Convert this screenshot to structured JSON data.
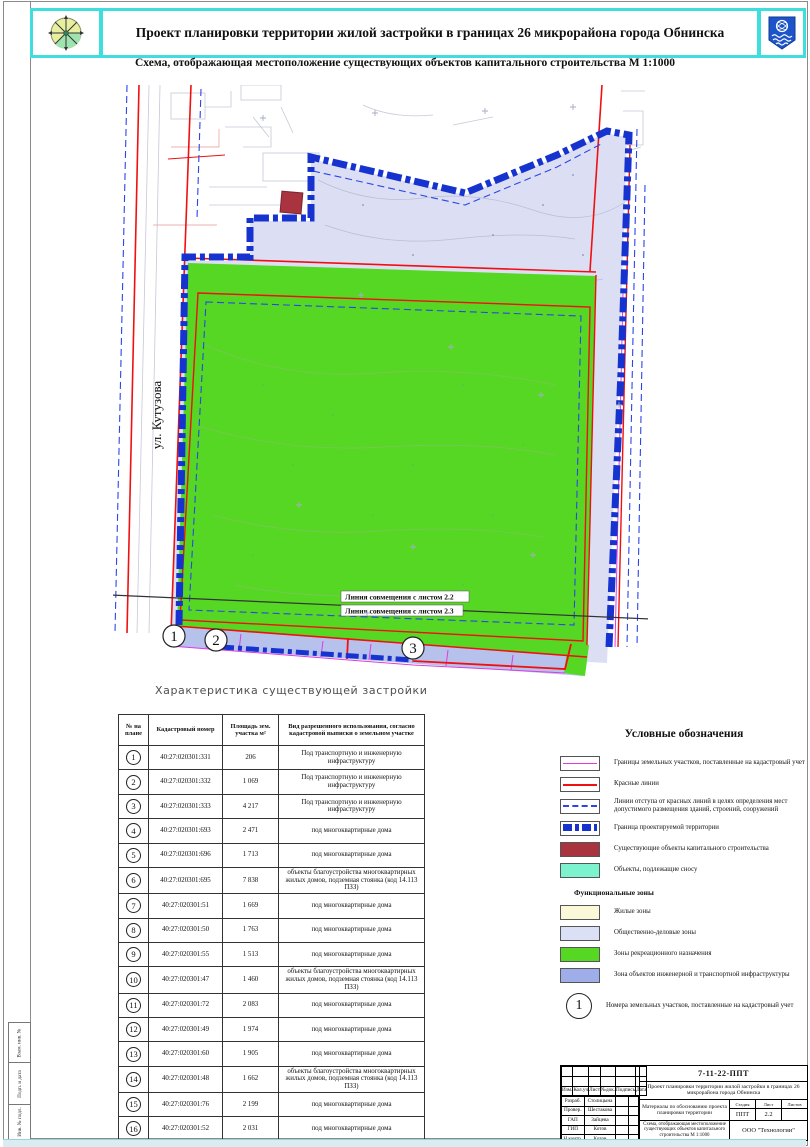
{
  "header": {
    "title": "Проект планировки территории жилой застройки в границах 26 микрорайона города Обнинска"
  },
  "subtitle": "Схема, отображающая местоположение существующих объектов капитального строительства М 1:1000",
  "map": {
    "street_label": "ул. Кутузова",
    "align_line_1": "Линия совмещения с листом 2.2",
    "align_line_2": "Линия совмещения с листом 2.3",
    "markers": [
      "1",
      "2",
      "3"
    ]
  },
  "table": {
    "heading": "Характеристика существующей застройки",
    "columns": [
      "№ на плане",
      "Кадастровый номер",
      "Площадь зем. участка м²",
      "Вид разрешенного использования, согласно кадастровой выписки о земельном участке"
    ],
    "rows": [
      {
        "num": "1",
        "cadastral": "40:27:020301:331",
        "area": "206",
        "use": "Под транспортную и инженерную инфраструктуру"
      },
      {
        "num": "2",
        "cadastral": "40:27:020301:332",
        "area": "1 069",
        "use": "Под транспортную и инженерную инфраструктуру"
      },
      {
        "num": "3",
        "cadastral": "40:27:020301:333",
        "area": "4 217",
        "use": "Под транспортную и инженерную инфраструктуру"
      },
      {
        "num": "4",
        "cadastral": "40:27:020301:693",
        "area": "2 471",
        "use": "под многоквартирные дома"
      },
      {
        "num": "5",
        "cadastral": "40:27:020301:696",
        "area": "1 713",
        "use": "под многоквартирные дома"
      },
      {
        "num": "6",
        "cadastral": "40:27:020301:695",
        "area": "7 838",
        "use": "объекты благоустройства многоквартирных жилых домов, подземная стоянка (код 14.113 ПЗЗ)"
      },
      {
        "num": "7",
        "cadastral": "40:27:020301:51",
        "area": "1 669",
        "use": "под многоквартирные дома"
      },
      {
        "num": "8",
        "cadastral": "40:27:020301:50",
        "area": "1 763",
        "use": "под многоквартирные дома"
      },
      {
        "num": "9",
        "cadastral": "40:27:020301:55",
        "area": "1 513",
        "use": "под многоквартирные дома"
      },
      {
        "num": "10",
        "cadastral": "40:27:020301:47",
        "area": "1 460",
        "use": "объекты благоустройства многоквартирных жилых домов, подземная стоянка (код 14.113 ПЗЗ)"
      },
      {
        "num": "11",
        "cadastral": "40:27:020301:72",
        "area": "2 083",
        "use": "под многоквартирные дома"
      },
      {
        "num": "12",
        "cadastral": "40:27:020301:49",
        "area": "1 974",
        "use": "под многоквартирные дома"
      },
      {
        "num": "13",
        "cadastral": "40:27:020301:60",
        "area": "1 905",
        "use": "под многоквартирные дома"
      },
      {
        "num": "14",
        "cadastral": "40:27:020301:48",
        "area": "1 662",
        "use": "объекты благоустройства многоквартирных жилых домов, подземная стоянка (код 14.113 ПЗЗ)"
      },
      {
        "num": "15",
        "cadastral": "40:27:020301:76",
        "area": "2 199",
        "use": "под многоквартирные дома"
      },
      {
        "num": "16",
        "cadastral": "40:27:020301:52",
        "area": "2 031",
        "use": "под многоквартирные дома"
      },
      {
        "num": "17",
        "cadastral": "40:27:020301:57",
        "area": "2 027",
        "use": "под многоквартирные дома"
      }
    ]
  },
  "legend": {
    "title": "Условные обозначения",
    "items": [
      {
        "swatch": "sw-parcel",
        "label": "Границы земельных участков, поставленные на кадастровый учет"
      },
      {
        "swatch": "sw-redline",
        "label": "Красные линии"
      },
      {
        "swatch": "sw-offset",
        "label": "Линии отступа от красных линий в целях определения мест допустимого размещения зданий, строений, сооружений"
      },
      {
        "swatch": "sw-boundary",
        "label": "Граница проектируемой территории"
      },
      {
        "swatch": "sw-existing",
        "label": "Существующие объекты капитального строительства"
      },
      {
        "swatch": "sw-demolish",
        "label": "Объекты, подлежащие сносу"
      }
    ],
    "zones_heading": "Функциональные зоны",
    "zones": [
      {
        "swatch": "sw-residential",
        "label": "Жилые зоны"
      },
      {
        "swatch": "sw-business",
        "label": "Общественно-деловые зоны"
      },
      {
        "swatch": "sw-recreation",
        "label": "Зоны рекреационного назначения"
      },
      {
        "swatch": "sw-infra",
        "label": "Зона объектов инженерной и транспортной инфраструктуры"
      }
    ],
    "number_item": {
      "symbol": "1",
      "label": "Номера земельных участков, поставленные на кадастровый учет"
    }
  },
  "stamp": {
    "doc_number": "7-11-22-ППТ",
    "project": "Проект планировки территории жилой застройки в границах 26 микрорайона города Обнинска",
    "header_cells": [
      "Изм.",
      "Кол.уч",
      "Лист",
      "№док.",
      "Подпись",
      "Дата"
    ],
    "roles": [
      {
        "role": "Разраб.",
        "name": "Столицына"
      },
      {
        "role": "Провер.",
        "name": "Шестакова"
      },
      {
        "role": "ГАП",
        "name": "Зайцева"
      },
      {
        "role": "ГИП",
        "name": "Котов"
      },
      {
        "role": "Н.контр.",
        "name": "Котов"
      }
    ],
    "materials": "Материалы по обоснованию проекта планировки территории",
    "stage_label": "Стадия",
    "sheet_label": "Лист",
    "sheets_label": "Листов",
    "stage": "ППТ",
    "sheet": "2.2",
    "sheets": "",
    "scheme": "Схема, отображающая местоположение существующих объектов капитального строительства М 1:1000",
    "company": "ООО \"Технологии\""
  },
  "frame": {
    "side_labels": [
      "Взам. инв. №",
      "Подп. и дата",
      "Инв. № подл."
    ]
  },
  "colors": {
    "frame_cyan": "#3fdede",
    "boundary_blue": "#1733cf",
    "red_line": "#f01010",
    "parcel_magenta": "#e23ae2",
    "offset_blue": "#2b46e8",
    "recreation_green": "#55d724",
    "business_lavender": "#dbe0f6",
    "infra_blue": "#9fade8",
    "existing_dark_red": "#a93440",
    "demolish_aqua": "#7df2cf",
    "residential_yellow": "#faf8d8"
  }
}
